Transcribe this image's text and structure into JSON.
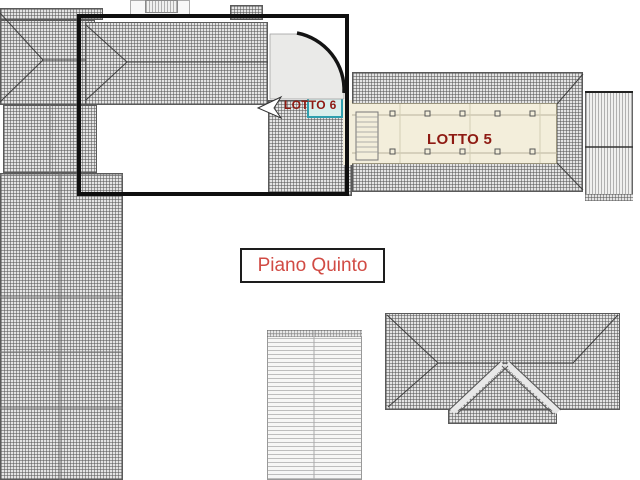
{
  "plan": {
    "floor_label": "Piano Quinto",
    "lot_labels": {
      "lotto5": "LOTTO 5",
      "lotto6": "LOTTO 6"
    },
    "colors": {
      "lot_label_text": "#8e1a12",
      "floor_label_text": "#d14b44",
      "floor_label_border": "#1d1d1d",
      "lotto6_highlight_border": "#2f9fae",
      "lotto6_highlight_fill": "#d9efec",
      "lotto5_interior": "#f3eedb",
      "selection_outline": "#0f0f0f",
      "hatch_gray": "#b8b8b8"
    }
  }
}
